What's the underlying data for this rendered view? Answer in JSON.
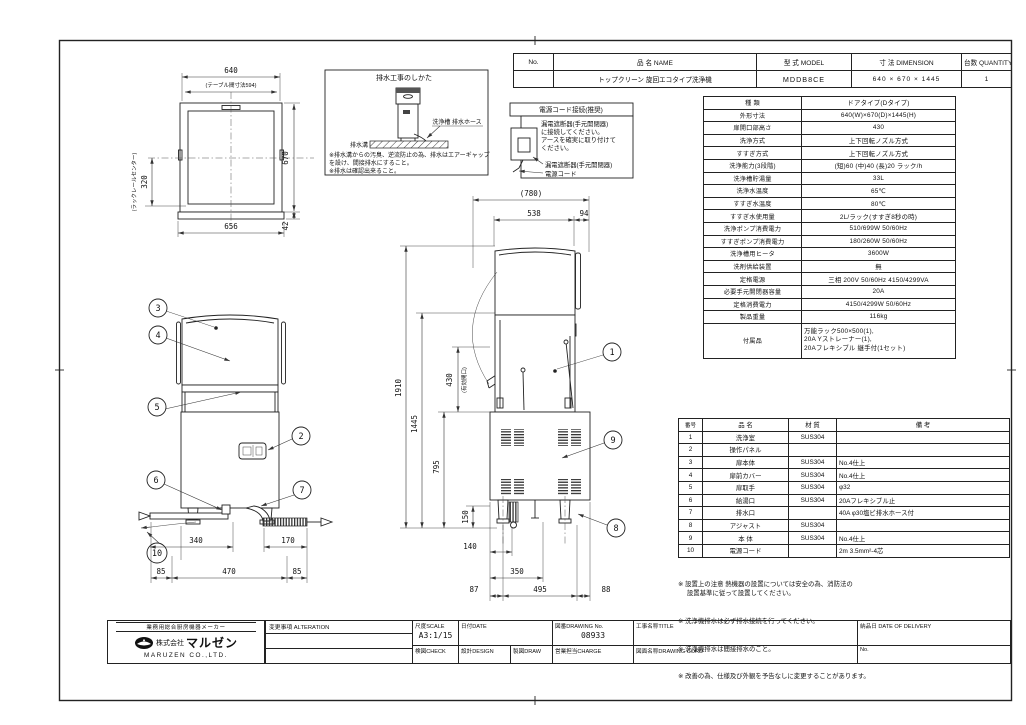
{
  "title_table": {
    "headers": {
      "no": "No.",
      "name": "品 名  NAME",
      "model": "型 式  MODEL",
      "dimension": "寸 法  DIMENSION",
      "quantity": "台数 QUANTITY"
    },
    "row": {
      "no": "",
      "name": "トップクリーン 旋回エコタイプ洗浄機",
      "model": "MDDB8CE",
      "dimension": "640 × 670 × 1445",
      "quantity": "1"
    }
  },
  "spec_table": {
    "rows": [
      {
        "label": "種  類",
        "value": "ドアタイプ(Dタイプ)"
      },
      {
        "label": "外形寸法",
        "value": "640(W)×670(D)×1445(H)"
      },
      {
        "label": "扉開口部高さ",
        "value": "430"
      },
      {
        "label": "洗浄方式",
        "value": "上下回転ノズル方式"
      },
      {
        "label": "すすぎ方式",
        "value": "上下回転ノズル方式"
      },
      {
        "label": "洗浄能力(3段階)",
        "value": "(短)60 (中)40 (長)20 ラック/h"
      },
      {
        "label": "洗浄槽貯湯量",
        "value": "33L"
      },
      {
        "label": "洗浄水温度",
        "value": "65℃"
      },
      {
        "label": "すすぎ水温度",
        "value": "80℃"
      },
      {
        "label": "すすぎ水使用量",
        "value": "2L/ラック(すすぎ8秒の時)"
      },
      {
        "label": "洗浄ポンプ消費電力",
        "value": "510/699W 50/60Hz"
      },
      {
        "label": "すすぎポンプ消費電力",
        "value": "180/260W 50/60Hz"
      },
      {
        "label": "洗浄槽用ヒータ",
        "value": "3600W"
      },
      {
        "label": "洗剤供給装置",
        "value": "無"
      },
      {
        "label": "定格電源",
        "value": "三相 200V 50/60Hz 4150/4299VA"
      },
      {
        "label": "必要手元開閉器容量",
        "value": "20A"
      },
      {
        "label": "定格消費電力",
        "value": "4150/4299W 50/60Hz"
      },
      {
        "label": "製品重量",
        "value": "116kg"
      },
      {
        "label": "付属品",
        "value": "万能ラック500×500(1),\n20A Yストレーナー(1),\n20Aフレキシブル 継手付(1セット)"
      }
    ]
  },
  "parts_table": {
    "headers": {
      "no": "番号",
      "name": "品  名",
      "material": "材  質",
      "remark": "備  考"
    },
    "rows": [
      {
        "no": "1",
        "name": "洗浄室",
        "material": "SUS304",
        "remark": ""
      },
      {
        "no": "2",
        "name": "操作パネル",
        "material": "",
        "remark": ""
      },
      {
        "no": "3",
        "name": "扉本体",
        "material": "SUS304",
        "remark": "No.4仕上"
      },
      {
        "no": "4",
        "name": "扉前カバー",
        "material": "SUS304",
        "remark": "No.4仕上"
      },
      {
        "no": "5",
        "name": "扉取手",
        "material": "SUS304",
        "remark": "φ32"
      },
      {
        "no": "6",
        "name": "給湯口",
        "material": "SUS304",
        "remark": "20Aフレキシブル止"
      },
      {
        "no": "7",
        "name": "排水口",
        "material": "",
        "remark": "40A φ30塩ビ排水ホース付"
      },
      {
        "no": "8",
        "name": "アジャスト",
        "material": "SUS304",
        "remark": ""
      },
      {
        "no": "9",
        "name": "本 体",
        "material": "SUS304",
        "remark": "No.4仕上"
      },
      {
        "no": "10",
        "name": "電源コード",
        "material": "",
        "remark": "2m 3.5mm²-4芯"
      }
    ]
  },
  "notes": [
    "※ 設置上の注意 熱機器の設置については安全の為、消防法の\n     設置基準に従って設置してください。",
    "※ 洗浄機排水は必ず排水接続を行ってください。",
    "※ 洗浄機排水は間接排水のこと。",
    "※ 改善の為、仕様及び外観を予告なしに変更することがあります。"
  ],
  "drain_box": {
    "title": "排水工事のしかた",
    "label_hose": "洗浄槽 排水ホース",
    "label_ditch": "排水溝",
    "note1": "※排水溝からの汚臭、逆流防止の為、排水はエアーギャップ",
    "note2": "  を設け、間接排水にすること。",
    "note3": "※排水は確認出来ること。"
  },
  "power_box": {
    "title": "電源コード接続(推奨)",
    "line1": "漏電遮断器(手元開閉器)",
    "line2": "に接続してください。",
    "line3": "アースを確実に取り付けて",
    "line4": "ください。",
    "label_breaker": "漏電遮断器(手元開閉器)",
    "label_cord": "電源コード"
  },
  "plan_view": {
    "dim_width_top": "640",
    "dim_table_span": "(テーブル間寸法594)",
    "dim_depth": "670",
    "dim_edge": "42",
    "dim_width_bottom": "656",
    "dim_rack": "320",
    "label_rack_center": "(ラックレールセンター)"
  },
  "front_view": {
    "dim_340": "340",
    "dim_170": "170",
    "dim_85L": "85",
    "dim_470": "470",
    "dim_85R": "85"
  },
  "side_view": {
    "dim_780": "(780)",
    "dim_538": "538",
    "dim_94": "94",
    "dim_1910": "1910",
    "dim_1445": "1445",
    "dim_795": "795",
    "dim_430": "430",
    "dim_430_note": "(有効開口)",
    "dim_150": "150",
    "dim_140": "140",
    "dim_350": "350",
    "dim_87": "87",
    "dim_495": "495",
    "dim_88": "88"
  },
  "callouts": {
    "c1": "1",
    "c2": "2",
    "c3": "3",
    "c4": "4",
    "c5": "5",
    "c6": "6",
    "c7": "7",
    "c8": "8",
    "c9": "9",
    "c10": "10"
  },
  "title_block": {
    "slogan": "業務用総合厨房機器メーカー",
    "company_prefix": "株式会社",
    "company_name": "マルゼン",
    "company_en": "MARUZEN CO.,LTD.",
    "alteration": "変更事項  ALTERATION",
    "scale_label": "尺度SCALE",
    "scale_value": "A3:1/15",
    "date_label": "日付DATE",
    "drawing_no_label": "図番DRAWING No.",
    "drawing_no": "08933",
    "title_label": "工事名称TITLE",
    "check_label": "検図CHECK",
    "design_label": "設計DESIGN",
    "draw_label": "製図DRAW",
    "charge_label": "営業担当CHARGE",
    "drawing_cord_label": "図面名称DRAWING CORD",
    "delivery_label": "納品日  DATE OF DELIVERY",
    "no_label": "No."
  }
}
